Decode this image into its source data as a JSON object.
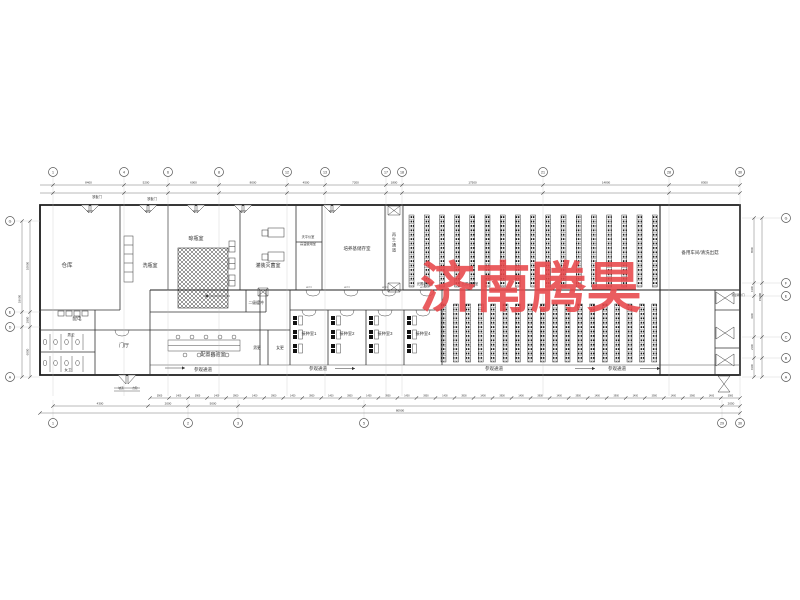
{
  "watermark": {
    "text": "济南腾昊",
    "color": "#e8474b"
  },
  "rooms": {
    "warehouse": "仓库",
    "wash": "洗瓶室",
    "dry": "晾瓶室",
    "fill": "灌装灭菌室",
    "balance": "天平仪室",
    "hitemp": "高温使用室",
    "medium": "培养基储存室",
    "regen": "再生通道",
    "spare": "备用车间/清洗出菇",
    "power": "配电",
    "wc_m": "男卫",
    "wc_f": "女卫",
    "hall": "门厅",
    "buffer2": "二级缓冲",
    "lab": "配置实验室",
    "chg_m": "男更",
    "chg_f": "女更",
    "inoc1": "接种室1",
    "inoc2": "接种室2",
    "inoc3": "接种室3",
    "inoc4": "接种室4",
    "light": "光照培养室",
    "corridor": "参观通道",
    "steel_door": "铁板门",
    "temp_door": "常温转换门",
    "ramp": "坡道",
    "steps": "台阶",
    "door_tag": "W727"
  },
  "grid": {
    "top": [
      "1",
      "4",
      "6",
      "8",
      "12",
      "13",
      "17",
      "18",
      "21",
      "28",
      "30"
    ],
    "bottom": [
      "1",
      "2",
      "3",
      "5",
      "29",
      "30"
    ],
    "left": [
      "G",
      "E",
      "D",
      "A"
    ],
    "right": [
      "G",
      "F",
      "E",
      "C",
      "B",
      "A"
    ]
  },
  "dims": {
    "top": [
      "8400",
      "5200",
      "6000",
      "8000",
      "4500",
      "7200",
      "1800",
      "17500",
      "14800",
      "8300"
    ],
    "chain": [
      "3900",
      "1400"
    ],
    "row2": [
      "4300",
      "2000",
      "5000",
      "2050"
    ],
    "total_bottom": "80900",
    "left": [
      "10800",
      "1800",
      "6000"
    ],
    "left_total": "18600",
    "right": [
      "6500",
      "1300",
      "4100",
      "2100",
      "1900"
    ],
    "right_total": "15900"
  }
}
